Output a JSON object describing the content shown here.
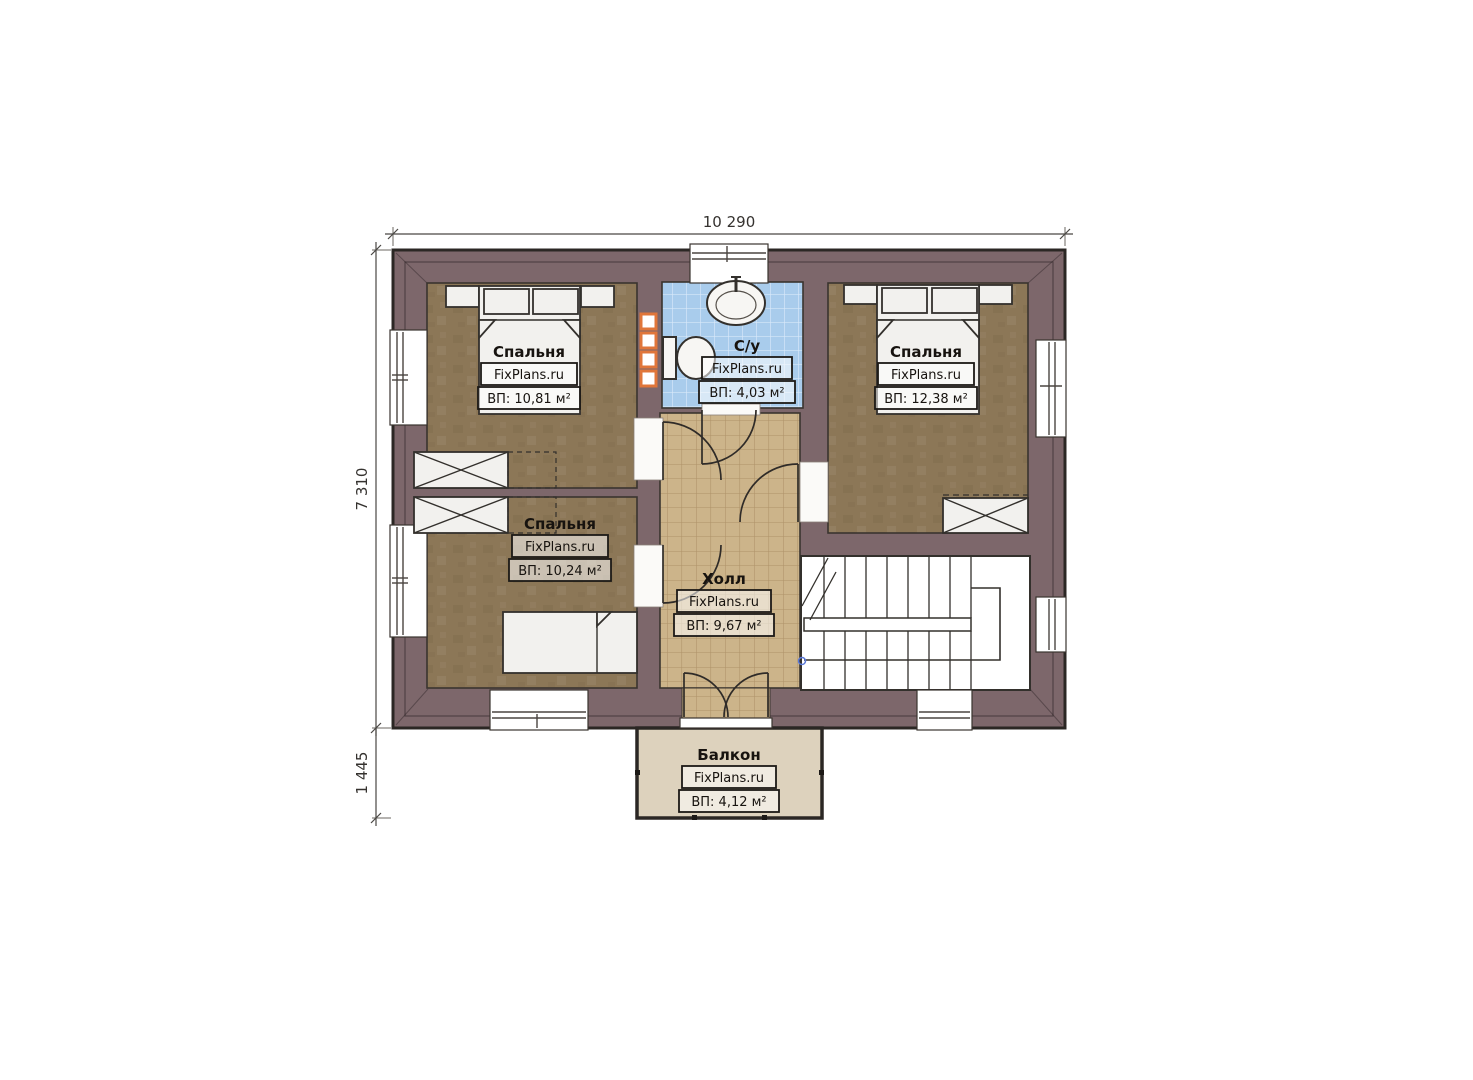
{
  "plan": {
    "brand": "FixPlans.ru",
    "dimensions": {
      "width_total": "10 290",
      "height_main": "7 310",
      "height_balcony": "1 445"
    },
    "rooms": {
      "bedroom_top_left": {
        "name": "Спальня",
        "brand": "FixPlans.ru",
        "area": "ВП: 10,81 м²"
      },
      "bathroom": {
        "name": "С/у",
        "brand": "FixPlans.ru",
        "area": "ВП: 4,03 м²"
      },
      "bedroom_top_right": {
        "name": "Спальня",
        "brand": "FixPlans.ru",
        "area": "ВП: 12,38 м²"
      },
      "bedroom_bottom_left": {
        "name": "Спальня",
        "brand": "FixPlans.ru",
        "area": "ВП: 10,24 м²"
      },
      "hall": {
        "name": "Холл",
        "brand": "FixPlans.ru",
        "area": "ВП: 9,67 м²"
      },
      "balcony": {
        "name": "Балкон",
        "brand": "FixPlans.ru",
        "area": "ВП: 4,12 м²"
      }
    },
    "colors": {
      "wall": "#7d676b",
      "bedroom_floor": "#8c7757",
      "hall_floor": "#ccb48a",
      "bathroom_tile": "#a9ccec",
      "balcony_floor": "#ddd2bd",
      "towel_rail_accent": "#e0763a",
      "outline": "#2b2724"
    }
  }
}
